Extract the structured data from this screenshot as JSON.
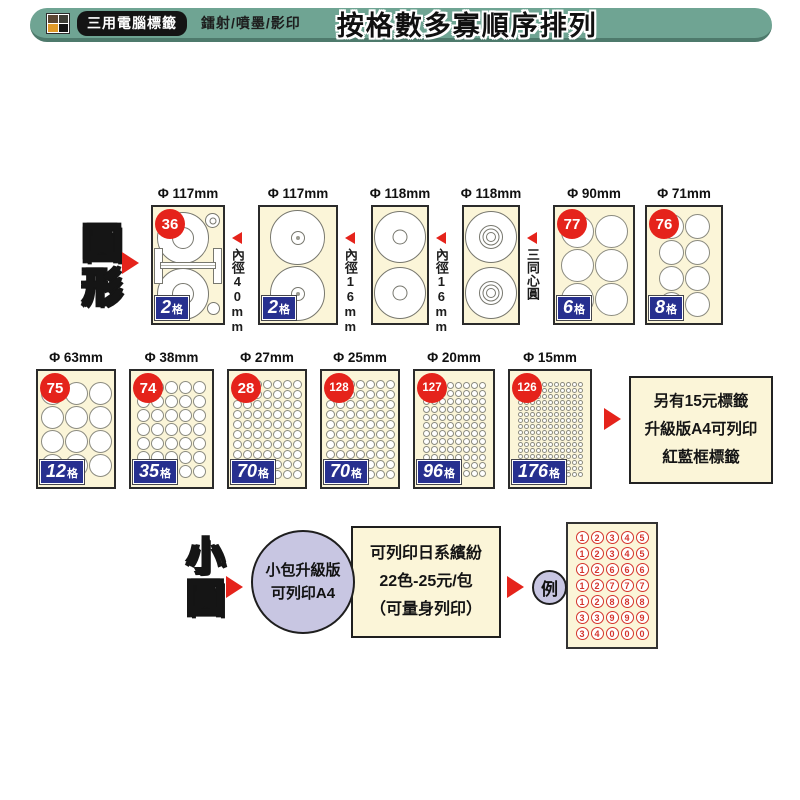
{
  "colors": {
    "header_green": "#6FA493",
    "header_green_dark": "#4E7A6C",
    "card_cream": "#FBF5D8",
    "badge_red": "#E5231B",
    "badge_blue": "#27308F",
    "bubble_lavender": "#C8C6E2",
    "circle_border": "#8B8B80",
    "number_red": "#D4342C"
  },
  "header": {
    "logo": "color-squares-logo",
    "brand": "三用電腦標籤",
    "subtitle": "鐳射/噴墨/影印",
    "title": "按格數多寡順序排列"
  },
  "round_section": {
    "label": "圓形",
    "arrow": "red-right-arrow",
    "cards": [
      {
        "diameter": "Φ 117mm",
        "badge": "36",
        "cells_num": "2",
        "cells_unit": "格",
        "type": "cd-spool",
        "width": 74,
        "annotation": "內徑40mm"
      },
      {
        "diameter": "Φ 117mm",
        "cells_num": "2",
        "cells_unit": "格",
        "type": "cd-dot-hole",
        "width": 80,
        "annotation": "內徑16mm"
      },
      {
        "diameter": "Φ 118mm",
        "type": "cd-ring-hole",
        "width": 58,
        "annotation": "內徑16mm"
      },
      {
        "diameter": "Φ 118mm",
        "type": "cd-concentric",
        "width": 58,
        "annotation": "三同心圓"
      },
      {
        "diameter": "Φ 90mm",
        "badge": "77",
        "cells_num": "6",
        "cells_unit": "格",
        "type": "grid",
        "cols": 2,
        "rows": 3,
        "width": 82
      },
      {
        "diameter": "Φ 71mm",
        "badge": "76",
        "cells_num": "8",
        "cells_unit": "格",
        "type": "grid",
        "cols": 2,
        "rows": 4,
        "width": 78
      }
    ]
  },
  "size_section": {
    "cards": [
      {
        "diameter": "Φ 63mm",
        "badge": "75",
        "cells_num": "12",
        "cells_unit": "格",
        "type": "grid",
        "cols": 3,
        "rows": 4,
        "width": 80
      },
      {
        "diameter": "Φ 38mm",
        "badge": "74",
        "cells_num": "35",
        "cells_unit": "格",
        "type": "grid",
        "cols": 5,
        "rows": 7,
        "width": 85
      },
      {
        "diameter": "Φ 27mm",
        "badge": "28",
        "cells_num": "70",
        "cells_unit": "格",
        "type": "grid",
        "cols": 7,
        "rows": 10,
        "width": 80
      },
      {
        "diameter": "Φ 25mm",
        "badge": "128",
        "cells_num": "70",
        "cells_unit": "格",
        "type": "grid",
        "cols": 7,
        "rows": 10,
        "width": 80
      },
      {
        "diameter": "Φ 20mm",
        "badge": "127",
        "cells_num": "96",
        "cells_unit": "格",
        "type": "grid",
        "cols": 8,
        "rows": 12,
        "width": 82
      },
      {
        "diameter": "Φ 15mm",
        "badge": "126",
        "cells_num": "176",
        "cells_unit": "格",
        "type": "grid",
        "cols": 11,
        "rows": 16,
        "width": 84
      }
    ],
    "note_lines": [
      "另有15元標籤",
      "升級版A4可列印",
      "紅藍框標籤"
    ]
  },
  "small_round_section": {
    "label": "小圓",
    "bubble_lines": [
      "小包升級版",
      "可列印A4"
    ],
    "box_lines": [
      "可列印日系繽紛",
      "22色-25元/包",
      "（可量身列印）"
    ],
    "example_label": "例",
    "example_rows": [
      [
        "1",
        "2",
        "3",
        "4",
        "5"
      ],
      [
        "1",
        "2",
        "3",
        "4",
        "5"
      ],
      [
        "1",
        "2",
        "6",
        "6",
        "6"
      ],
      [
        "1",
        "2",
        "7",
        "7",
        "7"
      ],
      [
        "1",
        "2",
        "8",
        "8",
        "8"
      ],
      [
        "3",
        "3",
        "9",
        "9",
        "9"
      ],
      [
        "3",
        "4",
        "0",
        "0",
        "0"
      ]
    ]
  }
}
